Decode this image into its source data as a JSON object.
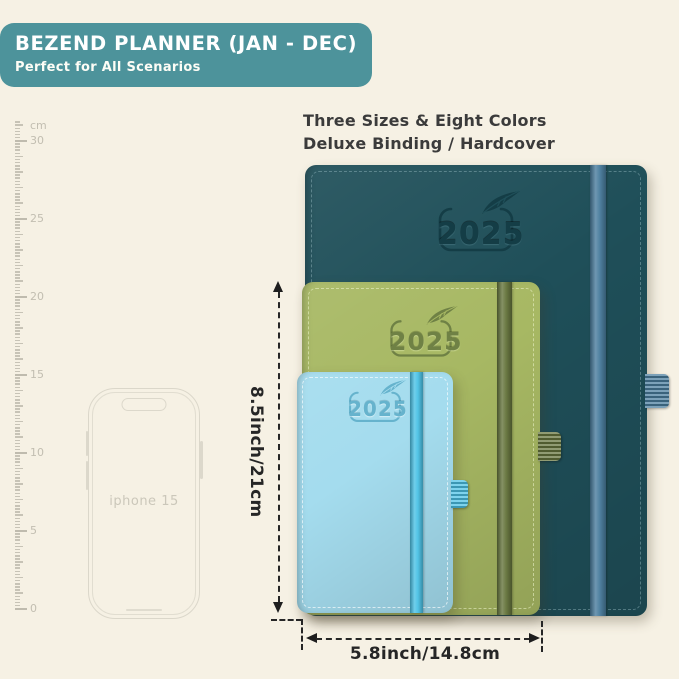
{
  "page": {
    "background_color": "#f6f1e4"
  },
  "header": {
    "title": "BEZEND PLANNER (JAN - DEC)",
    "subtitle": "Perfect for All Scenarios",
    "banner_color": "#4d939b",
    "text_color": "#ffffff"
  },
  "tagline": {
    "line1": "Three Sizes & Eight Colors",
    "line2": "Deluxe Binding / Hardcover"
  },
  "ruler": {
    "unit": "cm",
    "max_cm": 30,
    "labeled_marks": [
      30,
      25,
      20,
      15,
      10,
      5,
      0
    ]
  },
  "phone": {
    "label": "iphone 15"
  },
  "planners": [
    {
      "id": "large",
      "year": "2025",
      "cover_color": "#1f4f59",
      "band_color": "#4a7d9e",
      "logo_color": "#143d46"
    },
    {
      "id": "medium",
      "year": "2025",
      "cover_color": "#a7b863",
      "band_color": "#66753d",
      "logo_color": "#6f8145"
    },
    {
      "id": "small",
      "year": "2025",
      "cover_color": "#a4dcee",
      "band_color": "#4cc2e6",
      "logo_color": "#66b3cd"
    }
  ],
  "dimensions": {
    "height_label": "8.5inch/21cm",
    "width_label": "5.8inch/14.8cm"
  }
}
